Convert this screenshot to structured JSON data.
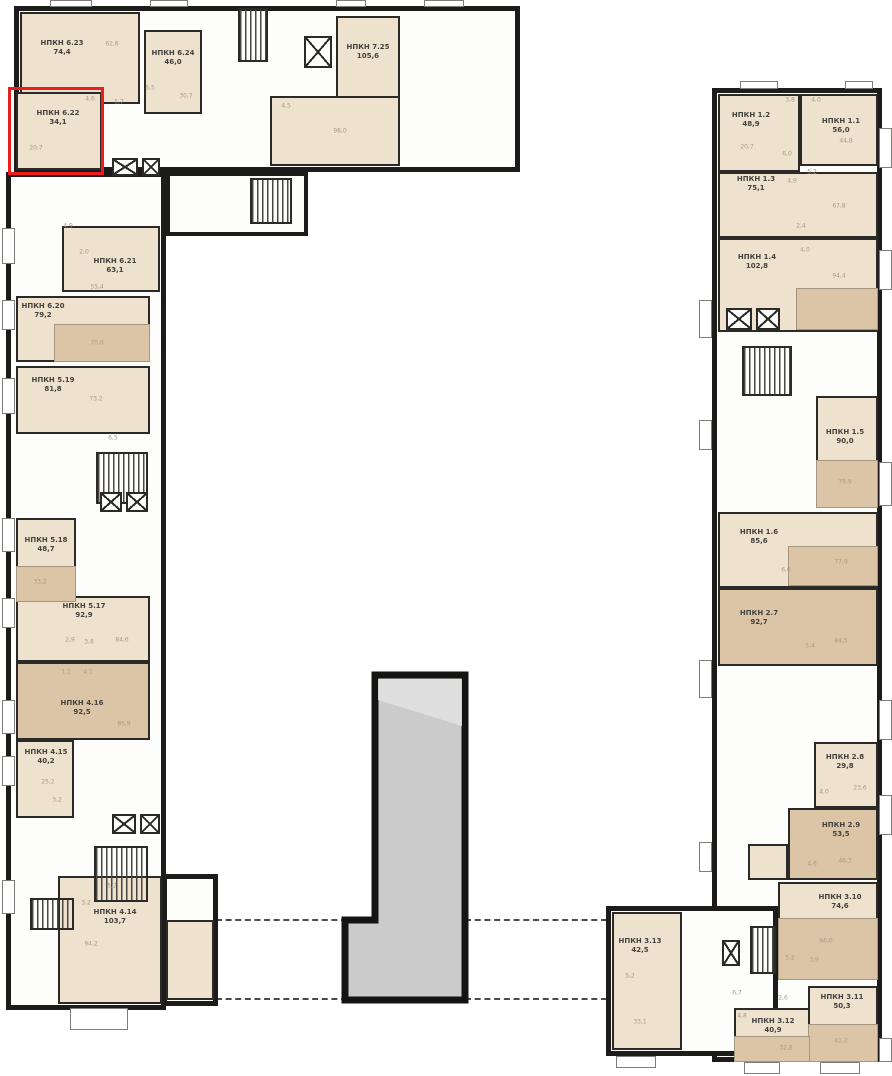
{
  "colors": {
    "walls": "#1d1c1a",
    "unit_fill_light": "#eee1cd",
    "unit_fill_dark": "#dcc5a6",
    "highlight_red": "#ee1c1c",
    "tower_gray": "#cbcbcb"
  },
  "highlight": {
    "unit": "6.22",
    "color": "#ee1c1c"
  },
  "units": [
    {
      "id": "6.23",
      "name": "НПКН 6.23",
      "area": "74,4",
      "sub": "62,6"
    },
    {
      "id": "6.24",
      "name": "НПКН 6.24",
      "area": "46,0",
      "sub": "30,7"
    },
    {
      "id": "7.25",
      "name": "НПКН 7.25",
      "area": "105,6",
      "sub": "98,0"
    },
    {
      "id": "6.22",
      "name": "НПКН 6.22",
      "area": "34,1",
      "sub": "20,7",
      "highlighted": true
    },
    {
      "id": "6.21",
      "name": "НПКН 6.21",
      "area": "63,1",
      "sub": "55,4"
    },
    {
      "id": "6.20",
      "name": "НПКН 6.20",
      "area": "79,2",
      "sub": "70,0"
    },
    {
      "id": "5.19",
      "name": "НПКН 5.19",
      "area": "81,8",
      "sub": "73,2"
    },
    {
      "id": "5.18",
      "name": "НПКН 5.18",
      "area": "48,7",
      "sub": "33,2"
    },
    {
      "id": "5.17",
      "name": "НПКН 5.17",
      "area": "92,9",
      "sub": "84,6"
    },
    {
      "id": "4.16",
      "name": "НПКН 4.16",
      "area": "92,5",
      "sub": "85,9"
    },
    {
      "id": "4.15",
      "name": "НПКН 4.15",
      "area": "40,2",
      "sub": "25,2"
    },
    {
      "id": "4.14",
      "name": "НПКН 4.14",
      "area": "103,7",
      "sub": "94,2"
    },
    {
      "id": "1.2",
      "name": "НПКН 1.2",
      "area": "48,9",
      "sub": "20,7"
    },
    {
      "id": "1.1",
      "name": "НПКН 1.1",
      "area": "56,0",
      "sub": "44,8"
    },
    {
      "id": "1.3",
      "name": "НПКН 1.3",
      "area": "75,1",
      "sub": "67,8"
    },
    {
      "id": "1.4",
      "name": "НПКН 1.4",
      "area": "102,8",
      "sub": "94,4"
    },
    {
      "id": "1.5",
      "name": "НПКН 1.5",
      "area": "90,0",
      "sub": "79,9"
    },
    {
      "id": "1.6",
      "name": "НПКН 1.6",
      "area": "85,6",
      "sub": "77,9"
    },
    {
      "id": "2.7",
      "name": "НПКН 2.7",
      "area": "92,7",
      "sub": "84,5"
    },
    {
      "id": "2.8",
      "name": "НПКН 2.8",
      "area": "29,8",
      "sub": "23,6"
    },
    {
      "id": "2.9",
      "name": "НПКН 2.9",
      "area": "53,5",
      "sub": "46,3"
    },
    {
      "id": "3.10",
      "name": "НПКН 3.10",
      "area": "74,6",
      "sub": "66,0"
    },
    {
      "id": "3.11",
      "name": "НПКН 3.11",
      "area": "50,3",
      "sub": "41,2"
    },
    {
      "id": "3.12",
      "name": "НПКН 3.12",
      "area": "40,9",
      "sub": "32,8"
    },
    {
      "id": "3.13",
      "name": "НПКН 3.13",
      "area": "42,5",
      "sub": "33,1"
    }
  ],
  "tech_areas": [
    "4,6",
    "5,7",
    "5,5",
    "4,5",
    "4,9",
    "2,0",
    "6,5",
    "2,9",
    "3,8",
    "1,1",
    "4,1",
    "3,2",
    "5,2",
    "3,2",
    "3,8",
    "4,0",
    "6,0",
    "5,2",
    "4,9",
    "2,4",
    "4,0",
    "6,0",
    "5,4",
    "4,0",
    "4,6",
    "5,2",
    "3,9",
    "6,7",
    "2,6",
    "4,8",
    "5,2"
  ]
}
